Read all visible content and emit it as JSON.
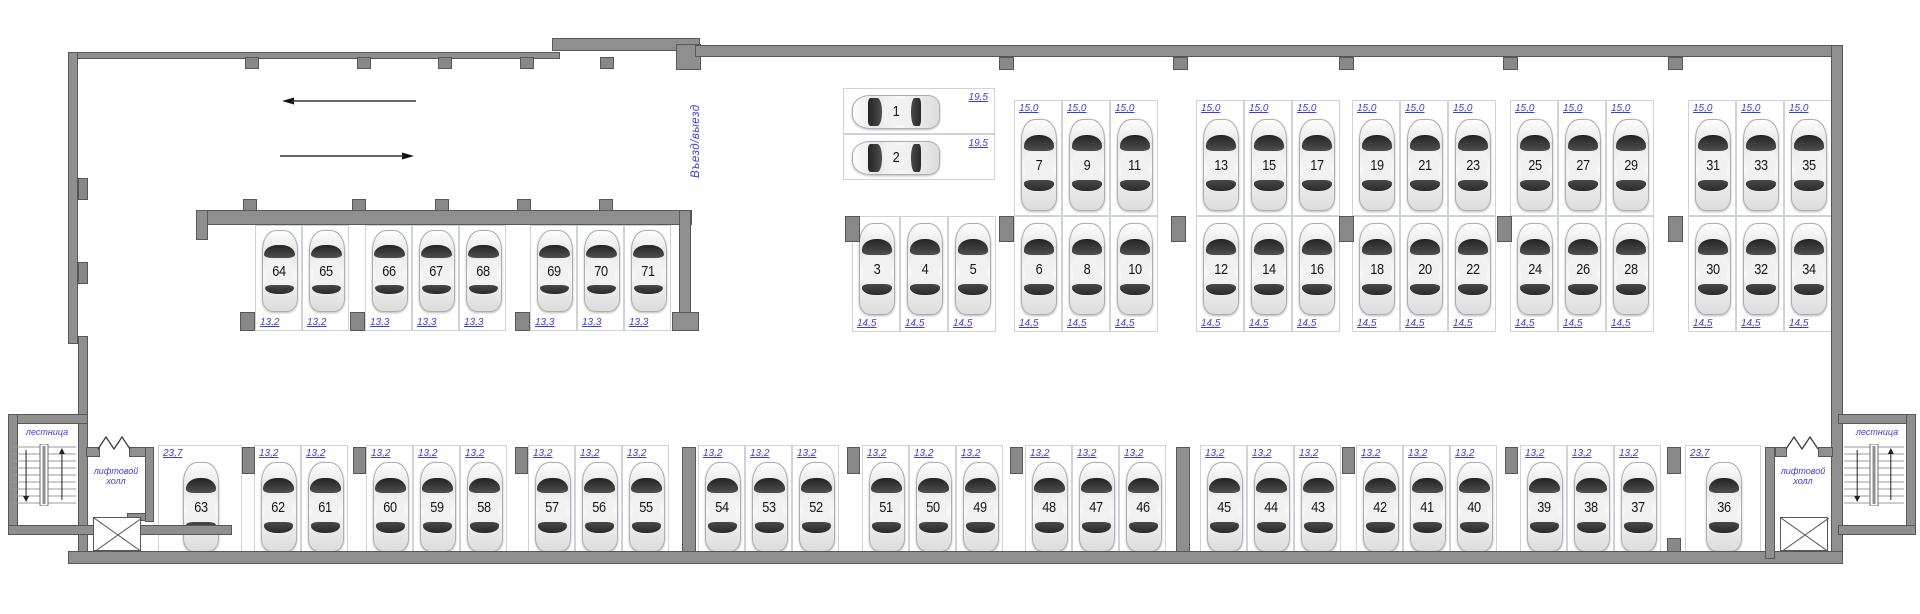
{
  "colors": {
    "wall": "#8f8f8f",
    "accent_blue": "#3c3ce0",
    "car_number": "#161616"
  },
  "labels": {
    "entrance": "Въезд/выезд",
    "stairs": "лестница",
    "lift_hall": "лифтовой холл"
  },
  "parking": {
    "entry_spots": [
      {
        "num": "1",
        "area": "19,5"
      },
      {
        "num": "2",
        "area": "19,5"
      }
    ],
    "upper_groups": [
      {
        "spots": [
          {
            "num": "7",
            "area": "15,0"
          },
          {
            "num": "9",
            "area": "15,0"
          },
          {
            "num": "11",
            "area": "15,0"
          }
        ]
      },
      {
        "spots": [
          {
            "num": "13",
            "area": "15,0"
          },
          {
            "num": "15",
            "area": "15,0"
          },
          {
            "num": "17",
            "area": "15,0"
          }
        ]
      },
      {
        "spots": [
          {
            "num": "19",
            "area": "15,0"
          },
          {
            "num": "21",
            "area": "15,0"
          },
          {
            "num": "23",
            "area": "15,0"
          }
        ]
      },
      {
        "spots": [
          {
            "num": "25",
            "area": "15,0"
          },
          {
            "num": "27",
            "area": "15,0"
          },
          {
            "num": "29",
            "area": "15,0"
          }
        ]
      },
      {
        "spots": [
          {
            "num": "31",
            "area": "15,0"
          },
          {
            "num": "33",
            "area": "15,0"
          },
          {
            "num": "35",
            "area": "15,0"
          }
        ]
      }
    ],
    "middle_groups": [
      {
        "spots": [
          {
            "num": "3",
            "area": "14,5"
          },
          {
            "num": "4",
            "area": "14,5"
          },
          {
            "num": "5",
            "area": "14,5"
          }
        ]
      },
      {
        "spots": [
          {
            "num": "6",
            "area": "14,5"
          },
          {
            "num": "8",
            "area": "14,5"
          },
          {
            "num": "10",
            "area": "14,5"
          }
        ]
      },
      {
        "spots": [
          {
            "num": "12",
            "area": "14,5"
          },
          {
            "num": "14",
            "area": "14,5"
          },
          {
            "num": "16",
            "area": "14,5"
          }
        ]
      },
      {
        "spots": [
          {
            "num": "18",
            "area": "14,5"
          },
          {
            "num": "20",
            "area": "14,5"
          },
          {
            "num": "22",
            "area": "14,5"
          }
        ]
      },
      {
        "spots": [
          {
            "num": "24",
            "area": "14,5"
          },
          {
            "num": "26",
            "area": "14,5"
          },
          {
            "num": "28",
            "area": "14,5"
          }
        ]
      },
      {
        "spots": [
          {
            "num": "30",
            "area": "14,5"
          },
          {
            "num": "32",
            "area": "14,5"
          },
          {
            "num": "34",
            "area": "14,5"
          }
        ]
      }
    ],
    "left_block_spots": [
      {
        "num": "64",
        "area": "13,2"
      },
      {
        "num": "65",
        "area": "13,2"
      },
      {
        "num": "66",
        "area": "13,3"
      },
      {
        "num": "67",
        "area": "13,3"
      },
      {
        "num": "68",
        "area": "13,3"
      },
      {
        "num": "69",
        "area": "13,3"
      },
      {
        "num": "70",
        "area": "13,3"
      },
      {
        "num": "71",
        "area": "13,3"
      }
    ],
    "bottom_spots": [
      {
        "num": "63",
        "area": "23,7"
      },
      {
        "num": "62",
        "area": "13,2"
      },
      {
        "num": "61",
        "area": "13,2"
      },
      {
        "num": "60",
        "area": "13,2"
      },
      {
        "num": "59",
        "area": "13,2"
      },
      {
        "num": "58",
        "area": "13,2"
      },
      {
        "num": "57",
        "area": "13,2"
      },
      {
        "num": "56",
        "area": "13,2"
      },
      {
        "num": "55",
        "area": "13,2"
      },
      {
        "num": "54",
        "area": "13,2"
      },
      {
        "num": "53",
        "area": "13,2"
      },
      {
        "num": "52",
        "area": "13,2"
      },
      {
        "num": "51",
        "area": "13,2"
      },
      {
        "num": "50",
        "area": "13,2"
      },
      {
        "num": "49",
        "area": "13,2"
      },
      {
        "num": "48",
        "area": "13,2"
      },
      {
        "num": "47",
        "area": "13,2"
      },
      {
        "num": "46",
        "area": "13,2"
      },
      {
        "num": "45",
        "area": "13,2"
      },
      {
        "num": "44",
        "area": "13,2"
      },
      {
        "num": "43",
        "area": "13,2"
      },
      {
        "num": "42",
        "area": "13,2"
      },
      {
        "num": "41",
        "area": "13,2"
      },
      {
        "num": "40",
        "area": "13,2"
      },
      {
        "num": "39",
        "area": "13,2"
      },
      {
        "num": "38",
        "area": "13,2"
      },
      {
        "num": "37",
        "area": "13,2"
      },
      {
        "num": "36",
        "area": "23,7"
      }
    ]
  }
}
